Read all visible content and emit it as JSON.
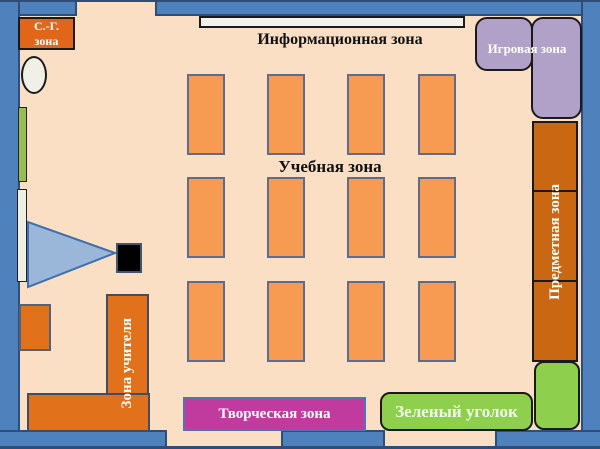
{
  "zones": {
    "sanitary": {
      "line1": "С.-Г.",
      "line2": "зона"
    },
    "info": {
      "label": "Информационная зона"
    },
    "play": {
      "label": "Игровая зона"
    },
    "study": {
      "label": "Учебная зона"
    },
    "subject": {
      "label": "Предметная зона"
    },
    "teacher": {
      "label": "Зона учителя"
    },
    "creative": {
      "label": "Творческая зона"
    },
    "green": {
      "label": "Зеленый уголок"
    }
  },
  "colors": {
    "floor": "#fbdfc4",
    "wall_blue": "#4f81bd",
    "wall_border_navy": "#2e4d79",
    "desk_orange": "#f89b52",
    "desk_border": "#5d6c8d",
    "furniture_orange": "#e2711c",
    "cabinet_orange": "#c96712",
    "sanitary_orange": "#e2661a",
    "play_purple": "#b1a0c7",
    "green_corner": "#8ed04e",
    "wall_strip_green": "#9bbb59",
    "creative_magenta": "#c13a9e",
    "beam_blue": "#9ab6d9",
    "projector_black": "#000000",
    "board_white": "#f3f2ea"
  },
  "desk_grid": {
    "cols": [
      187,
      267,
      347,
      418
    ],
    "rows": [
      74,
      177,
      281
    ],
    "desk_width": 38,
    "desk_height": 81
  }
}
